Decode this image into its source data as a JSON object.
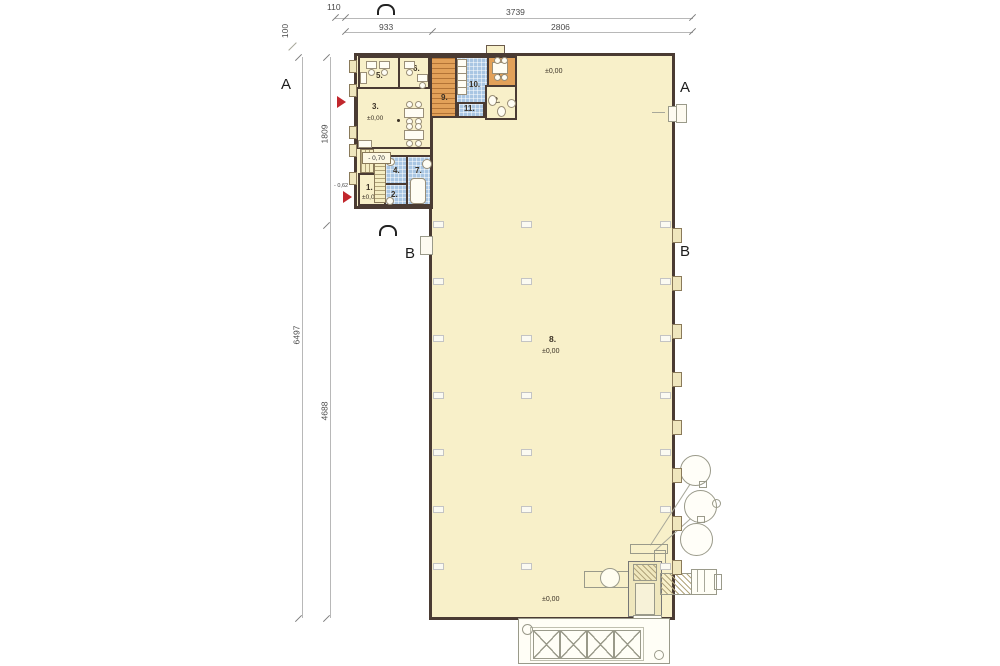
{
  "drawing": {
    "type": "architectural floor plan",
    "wall_color": "#4a3b33",
    "fill_cream": "#f8f0c9",
    "fill_blue": "#a9c6e3",
    "fill_orange": "#e2a159",
    "accent_red": "#c1272d"
  },
  "dims": {
    "top_small": "110",
    "top_total": "3739",
    "top_sub_left": "933",
    "top_sub_right": "2806",
    "left_small": "100",
    "left_total": "6497",
    "left_upper": "1809",
    "left_lower": "4688"
  },
  "sections": {
    "a": "A",
    "b": "B"
  },
  "elevations": {
    "zero": "±0,00",
    "minus70": "- 0,70",
    "minus62": "- 0,62"
  },
  "hall": {
    "label": "8."
  },
  "rooms": [
    {
      "id": "3",
      "label": "3.",
      "elevation": "±0,00",
      "kind": "cream",
      "x": 356,
      "y": 87,
      "w": 76,
      "h": 62,
      "lx": 14,
      "ly": 13,
      "ex": 9,
      "ey": 26
    },
    {
      "id": "5",
      "label": "5.",
      "kind": "cream",
      "x": 358,
      "y": 56,
      "w": 42,
      "h": 33,
      "lx": 16,
      "ly": 13
    },
    {
      "id": "6",
      "label": "6.",
      "kind": "cream",
      "x": 398,
      "y": 56,
      "w": 32,
      "h": 33,
      "lx": 13,
      "ly": 6
    },
    {
      "id": "1",
      "label": "1.",
      "elevation": "±0,00",
      "kind": "cream",
      "x": 358,
      "y": 173,
      "w": 28,
      "h": 33,
      "lx": 6,
      "ly": 8,
      "ex": 2,
      "ey": 19
    },
    {
      "id": "4",
      "label": "4.",
      "kind": "blue",
      "x": 384,
      "y": 155,
      "w": 24,
      "h": 30,
      "lx": 7,
      "ly": 9
    },
    {
      "id": "2",
      "label": "2.",
      "kind": "blue",
      "x": 384,
      "y": 183,
      "w": 24,
      "h": 23,
      "lx": 5,
      "ly": 5
    },
    {
      "id": "7",
      "label": "7.",
      "kind": "blue",
      "x": 406,
      "y": 155,
      "w": 26,
      "h": 51,
      "lx": 7,
      "ly": 9
    },
    {
      "id": "9",
      "label": "9.",
      "kind": "orange",
      "hatch": true,
      "x": 430,
      "y": 56,
      "w": 27,
      "h": 62,
      "lx": 9,
      "ly": 35
    },
    {
      "id": "10",
      "label": "10.",
      "kind": "blue",
      "x": 455,
      "y": 56,
      "w": 34,
      "h": 48,
      "lx": 12,
      "ly": 22
    },
    {
      "id": "11",
      "label": "11.",
      "kind": "blue",
      "x": 457,
      "y": 102,
      "w": 28,
      "h": 16,
      "lx": 5,
      "ly": 0
    },
    {
      "id": "13",
      "label": "13.",
      "kind": "orange",
      "x": 487,
      "y": 56,
      "w": 30,
      "h": 31,
      "lx": 8,
      "ly": 12
    },
    {
      "id": "12",
      "label": "12.",
      "kind": "cream",
      "x": 485,
      "y": 85,
      "w": 32,
      "h": 35,
      "lx": 2,
      "ly": 9
    }
  ],
  "furniture": [
    {
      "k": "desk",
      "x": 366,
      "y": 61,
      "w": 9,
      "h": 6
    },
    {
      "k": "chair",
      "x": 368,
      "y": 69,
      "w": 5,
      "h": 5
    },
    {
      "k": "desk",
      "x": 379,
      "y": 61,
      "w": 9,
      "h": 6
    },
    {
      "k": "chair",
      "x": 381,
      "y": 69,
      "w": 5,
      "h": 5
    },
    {
      "k": "cab",
      "x": 360,
      "y": 72,
      "w": 5,
      "h": 10
    },
    {
      "k": "desk",
      "x": 404,
      "y": 61,
      "w": 9,
      "h": 6
    },
    {
      "k": "chair",
      "x": 406,
      "y": 69,
      "w": 5,
      "h": 5
    },
    {
      "k": "desk",
      "x": 417,
      "y": 74,
      "w": 9,
      "h": 6
    },
    {
      "k": "chair",
      "x": 419,
      "y": 82,
      "w": 5,
      "h": 5
    },
    {
      "k": "desk",
      "x": 404,
      "y": 108,
      "w": 18,
      "h": 8
    },
    {
      "k": "chair",
      "x": 406,
      "y": 101,
      "w": 5,
      "h": 5
    },
    {
      "k": "chair",
      "x": 415,
      "y": 101,
      "w": 5,
      "h": 5
    },
    {
      "k": "chair",
      "x": 406,
      "y": 118,
      "w": 5,
      "h": 5
    },
    {
      "k": "chair",
      "x": 415,
      "y": 118,
      "w": 5,
      "h": 5
    },
    {
      "k": "desk",
      "x": 404,
      "y": 130,
      "w": 18,
      "h": 8
    },
    {
      "k": "chair",
      "x": 406,
      "y": 123,
      "w": 5,
      "h": 5
    },
    {
      "k": "chair",
      "x": 415,
      "y": 123,
      "w": 5,
      "h": 5
    },
    {
      "k": "chair",
      "x": 406,
      "y": 140,
      "w": 5,
      "h": 5
    },
    {
      "k": "chair",
      "x": 415,
      "y": 140,
      "w": 5,
      "h": 5
    },
    {
      "k": "cab",
      "x": 358,
      "y": 140,
      "w": 12,
      "h": 6
    },
    {
      "k": "dot",
      "x": 397,
      "y": 119,
      "w": 3,
      "h": 3
    },
    {
      "k": "table",
      "x": 492,
      "y": 62,
      "w": 14,
      "h": 10
    },
    {
      "k": "chair",
      "x": 494,
      "y": 57,
      "w": 5,
      "h": 5
    },
    {
      "k": "chair",
      "x": 501,
      "y": 57,
      "w": 5,
      "h": 5
    },
    {
      "k": "chair",
      "x": 494,
      "y": 74,
      "w": 5,
      "h": 5
    },
    {
      "k": "chair",
      "x": 501,
      "y": 74,
      "w": 5,
      "h": 5
    },
    {
      "k": "locker",
      "x": 457,
      "y": 59,
      "w": 8,
      "h": 6
    },
    {
      "k": "locker",
      "x": 457,
      "y": 66,
      "w": 8,
      "h": 6
    },
    {
      "k": "locker",
      "x": 457,
      "y": 73,
      "w": 8,
      "h": 6
    },
    {
      "k": "locker",
      "x": 457,
      "y": 80,
      "w": 8,
      "h": 6
    },
    {
      "k": "locker",
      "x": 457,
      "y": 87,
      "w": 8,
      "h": 6
    },
    {
      "k": "wc",
      "x": 488,
      "y": 95,
      "w": 7,
      "h": 9
    },
    {
      "k": "wc",
      "x": 497,
      "y": 106,
      "w": 7,
      "h": 9
    },
    {
      "k": "sink",
      "x": 507,
      "y": 99,
      "w": 7,
      "h": 7
    },
    {
      "k": "tub",
      "x": 410,
      "y": 178,
      "w": 14,
      "h": 24
    },
    {
      "k": "wc",
      "x": 422,
      "y": 159,
      "w": 8,
      "h": 8
    },
    {
      "k": "sink",
      "x": 386,
      "y": 158,
      "w": 7,
      "h": 6
    },
    {
      "k": "sink",
      "x": 386,
      "y": 197,
      "w": 6,
      "h": 6
    }
  ],
  "structure": {
    "pilaster_ys": [
      228,
      276,
      324,
      372,
      420,
      468,
      516,
      560
    ],
    "wing_bump_ys": [
      60,
      84,
      126,
      144,
      172
    ],
    "column_rows": [
      221,
      278,
      335,
      392,
      449,
      506,
      563
    ],
    "column_xs": [
      433,
      521,
      660
    ],
    "conveyor_segment_xs": [
      533,
      560,
      587,
      614
    ],
    "tanks": [
      {
        "x": 680,
        "y": 455,
        "d": 29
      },
      {
        "x": 684,
        "y": 490,
        "d": 31
      },
      {
        "x": 680,
        "y": 523,
        "d": 31
      }
    ]
  }
}
